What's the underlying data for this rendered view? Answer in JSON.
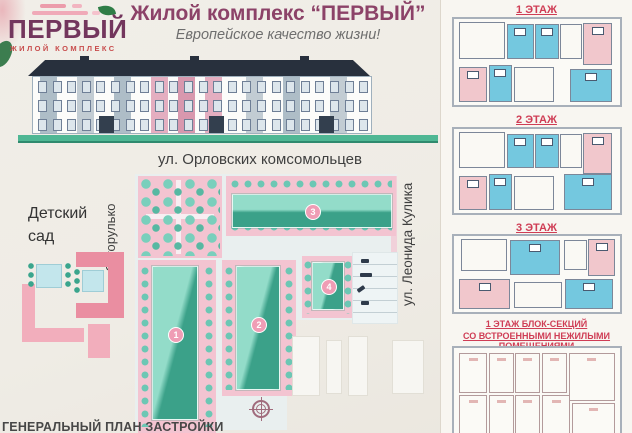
{
  "colors": {
    "title_accent": "#8c4268",
    "brand_purple": "#73365d",
    "brand_red": "#c84c4c",
    "plan_label_red": "#cf3d55",
    "building_teal_light": "#93dcc9",
    "building_teal_dark": "#3ba189",
    "block_pink": "#f3c4d1",
    "room_blue": "#74c8df",
    "room_pink": "#f1c7cc",
    "roof_dark": "#28303d",
    "ground_green": "#4fb794"
  },
  "logo": {
    "brand": "ПЕРВЫЙ",
    "tagline": "ЖИЛОЙ КОМПЛЕКС"
  },
  "header": {
    "title": "Жилой комплекс “ПЕРВЫЙ”",
    "subtitle": "Европейское качество жизни!"
  },
  "site_plan": {
    "street_top": "ул. Орловских комсомольцев",
    "street_left": "ул. Загорулько",
    "street_right": "ул. Леонида Кулика",
    "kindergarten": "Детский\nсад",
    "caption": "ГЕНЕРАЛЬНЫЙ ПЛАН ЗАСТРОЙКИ",
    "building_numbers": [
      "1",
      "2",
      "3",
      "4"
    ]
  },
  "floor_plans": [
    {
      "label": "1 ЭТАЖ",
      "rooms": [
        {
          "x": 3,
          "y": 4,
          "w": 28,
          "h": 42,
          "c": "white"
        },
        {
          "x": 32,
          "y": 6,
          "w": 16,
          "h": 40,
          "c": "blue"
        },
        {
          "x": 49,
          "y": 6,
          "w": 14,
          "h": 40,
          "c": "blue"
        },
        {
          "x": 64,
          "y": 6,
          "w": 13,
          "h": 40,
          "c": "white"
        },
        {
          "x": 78,
          "y": 5,
          "w": 17,
          "h": 48,
          "c": "pink"
        },
        {
          "x": 3,
          "y": 56,
          "w": 17,
          "h": 40,
          "c": "pink"
        },
        {
          "x": 21,
          "y": 54,
          "w": 14,
          "h": 42,
          "c": "blue"
        },
        {
          "x": 36,
          "y": 56,
          "w": 24,
          "h": 40,
          "c": "white"
        },
        {
          "x": 70,
          "y": 58,
          "w": 25,
          "h": 38,
          "c": "blue"
        }
      ]
    },
    {
      "label": "2 ЭТАЖ",
      "rooms": [
        {
          "x": 3,
          "y": 4,
          "w": 28,
          "h": 42,
          "c": "white"
        },
        {
          "x": 32,
          "y": 6,
          "w": 16,
          "h": 40,
          "c": "blue"
        },
        {
          "x": 49,
          "y": 6,
          "w": 14,
          "h": 40,
          "c": "blue"
        },
        {
          "x": 64,
          "y": 6,
          "w": 13,
          "h": 40,
          "c": "white"
        },
        {
          "x": 78,
          "y": 5,
          "w": 17,
          "h": 48,
          "c": "pink"
        },
        {
          "x": 3,
          "y": 56,
          "w": 17,
          "h": 40,
          "c": "pink"
        },
        {
          "x": 21,
          "y": 54,
          "w": 14,
          "h": 42,
          "c": "blue"
        },
        {
          "x": 36,
          "y": 56,
          "w": 24,
          "h": 40,
          "c": "white"
        },
        {
          "x": 66,
          "y": 54,
          "w": 29,
          "h": 42,
          "c": "blue"
        }
      ]
    },
    {
      "label": "3 ЭТАЖ",
      "rooms": [
        {
          "x": 4,
          "y": 4,
          "w": 28,
          "h": 42,
          "c": "white"
        },
        {
          "x": 34,
          "y": 5,
          "w": 30,
          "h": 46,
          "c": "blue"
        },
        {
          "x": 66,
          "y": 5,
          "w": 14,
          "h": 40,
          "c": "white"
        },
        {
          "x": 81,
          "y": 4,
          "w": 16,
          "h": 48,
          "c": "pink"
        },
        {
          "x": 3,
          "y": 56,
          "w": 31,
          "h": 40,
          "c": "pink"
        },
        {
          "x": 36,
          "y": 60,
          "w": 29,
          "h": 35,
          "c": "white"
        },
        {
          "x": 67,
          "y": 56,
          "w": 29,
          "h": 40,
          "c": "blue"
        }
      ]
    },
    {
      "label": "1 ЭТАЖ БЛОК-СЕКЦИЙ",
      "label2": "СО ВСТРОЕННЫМИ НЕЖИЛЫМИ ПОМЕЩЕНИЯМИ",
      "rooms": [
        {
          "x": 3,
          "y": 6,
          "w": 17,
          "h": 44,
          "c": "outline"
        },
        {
          "x": 21,
          "y": 6,
          "w": 15,
          "h": 44,
          "c": "outline"
        },
        {
          "x": 37,
          "y": 6,
          "w": 15,
          "h": 44,
          "c": "outline"
        },
        {
          "x": 53,
          "y": 6,
          "w": 15,
          "h": 44,
          "c": "outline"
        },
        {
          "x": 69,
          "y": 6,
          "w": 28,
          "h": 52,
          "c": "outline"
        },
        {
          "x": 3,
          "y": 52,
          "w": 17,
          "h": 44,
          "c": "outline"
        },
        {
          "x": 21,
          "y": 52,
          "w": 15,
          "h": 44,
          "c": "outline"
        },
        {
          "x": 37,
          "y": 52,
          "w": 15,
          "h": 44,
          "c": "outline"
        },
        {
          "x": 53,
          "y": 52,
          "w": 17,
          "h": 44,
          "c": "outline"
        },
        {
          "x": 71,
          "y": 60,
          "w": 26,
          "h": 36,
          "c": "outline"
        }
      ]
    }
  ]
}
